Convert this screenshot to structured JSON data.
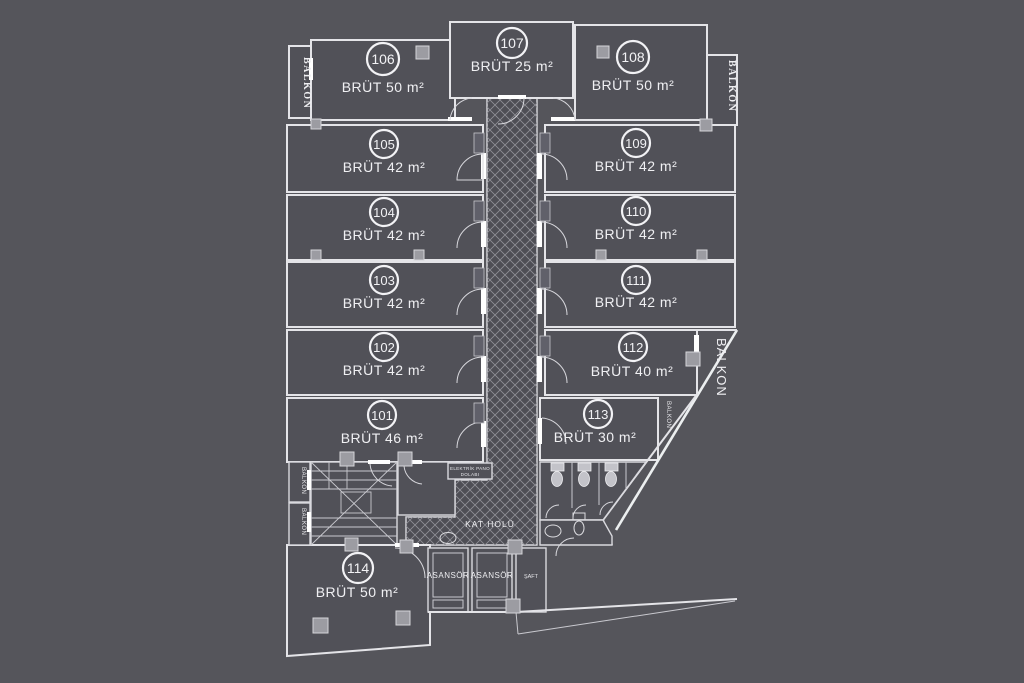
{
  "plan": {
    "colors": {
      "background": "#55555b",
      "room_fill": "#515158",
      "wall": "#e4e4e8",
      "text": "#f0f0f3",
      "hatch_line": "#8f8f96"
    },
    "units": [
      {
        "number": "101",
        "area": "BRÜT 46 m²"
      },
      {
        "number": "102",
        "area": "BRÜT 42 m²"
      },
      {
        "number": "103",
        "area": "BRÜT 42 m²"
      },
      {
        "number": "104",
        "area": "BRÜT 42 m²"
      },
      {
        "number": "105",
        "area": "BRÜT 42 m²"
      },
      {
        "number": "106",
        "area": "BRÜT 50 m²"
      },
      {
        "number": "107",
        "area": "BRÜT 25 m²"
      },
      {
        "number": "108",
        "area": "BRÜT 50 m²"
      },
      {
        "number": "109",
        "area": "BRÜT 42 m²"
      },
      {
        "number": "110",
        "area": "BRÜT 42 m²"
      },
      {
        "number": "111",
        "area": "BRÜT 42 m²"
      },
      {
        "number": "112",
        "area": "BRÜT 40 m²"
      },
      {
        "number": "113",
        "area": "BRÜT 30 m²"
      },
      {
        "number": "114",
        "area": "BRÜT 50 m²"
      }
    ],
    "labels": {
      "balkon": "BALKON",
      "kat_holu": "KAT HOLÜ",
      "asansor": "ASANSÖR",
      "saft": "ŞAFT",
      "elektrik_line1": "ELEKTRİK PANO",
      "elektrik_line2": "DOLABI"
    }
  }
}
